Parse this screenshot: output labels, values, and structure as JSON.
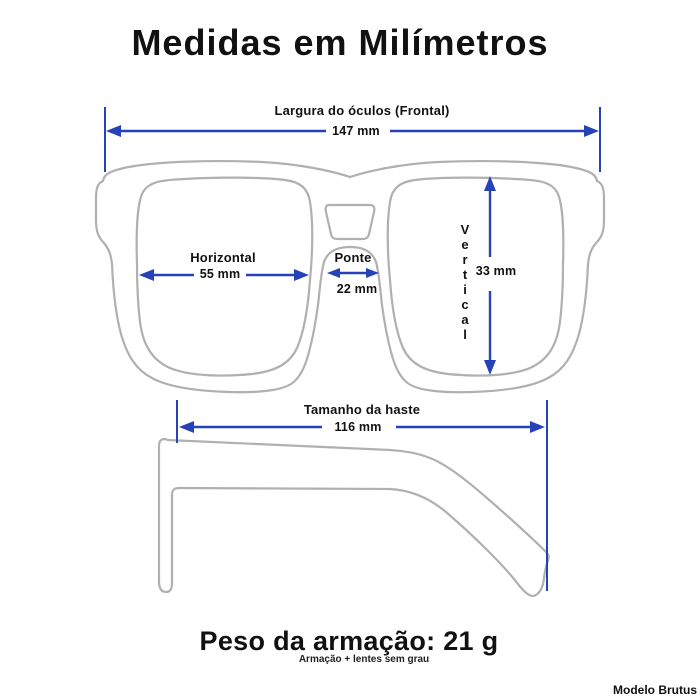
{
  "title": "Medidas em Milímetros",
  "colors": {
    "accent_blue": "#2642b8",
    "outline_gray": "#b0b0b0",
    "text_black": "#111111"
  },
  "measurements": {
    "frame_width": {
      "label": "Largura do óculos (Frontal)",
      "value": "147 mm"
    },
    "lens_horizontal": {
      "label": "Horizontal",
      "value": "55 mm"
    },
    "bridge": {
      "label": "Ponte",
      "value": "22 mm"
    },
    "lens_vertical": {
      "label": "Vertical",
      "value": "33 mm"
    },
    "temple": {
      "label": "Tamanho da haste",
      "value": "116 mm"
    }
  },
  "footer": {
    "weight": "Peso da armação: 21 g",
    "note": "Armação + lentes sem grau",
    "model": "Modelo Brutus"
  }
}
